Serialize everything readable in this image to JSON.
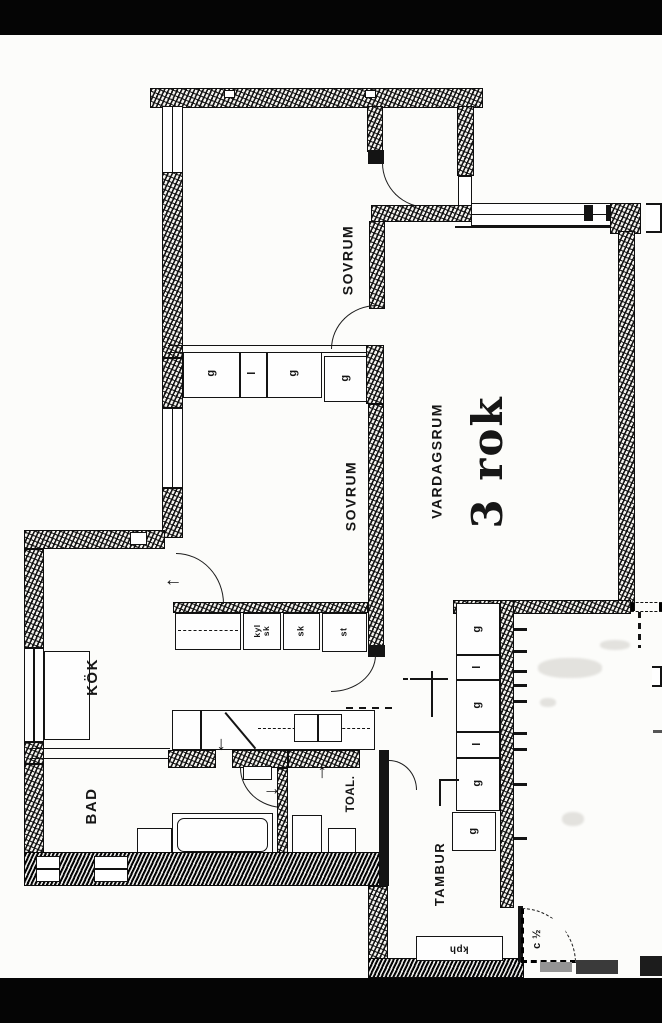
{
  "plan": {
    "apartment_type": "3 rok",
    "rooms": [
      {
        "label": "SOVRUM"
      },
      {
        "label": "SOVRUM"
      },
      {
        "label": "VARDAGSRUM"
      },
      {
        "label": "KÖK"
      },
      {
        "label": "BAD"
      },
      {
        "label": "TOAL."
      },
      {
        "label": "TAMBUR"
      }
    ],
    "closets": {
      "bedroom_row": [
        "g",
        "l",
        "g",
        "g"
      ],
      "hall_row": [
        "kyl\nsk",
        "sk",
        "st"
      ],
      "tambur_column": [
        "g",
        "l",
        "g",
        "l",
        "g",
        "g"
      ],
      "entry_shelf": "kph"
    },
    "notes": {
      "door_note": "c ½"
    },
    "symbols": {
      "arrow_left": "←",
      "arrow_down": "↓",
      "arrow_up": "↑",
      "arrow_right": "→"
    }
  }
}
